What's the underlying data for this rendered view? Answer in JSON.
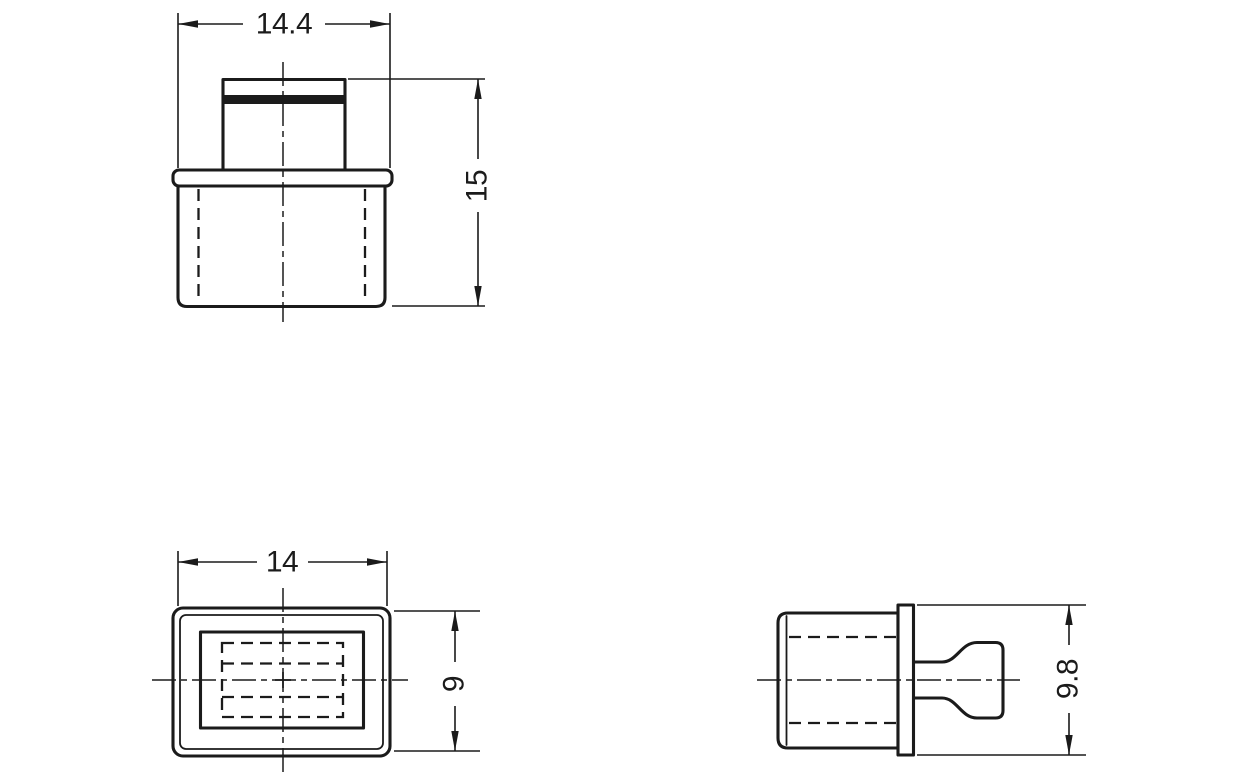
{
  "colors": {
    "ink": "#1b1b1b",
    "paper": "#ffffff"
  },
  "views": {
    "front": {
      "dim_width": "14.4",
      "dim_height": "15"
    },
    "top": {
      "dim_width": "14",
      "dim_depth": "9"
    },
    "side": {
      "dim_height": "9.8"
    }
  }
}
